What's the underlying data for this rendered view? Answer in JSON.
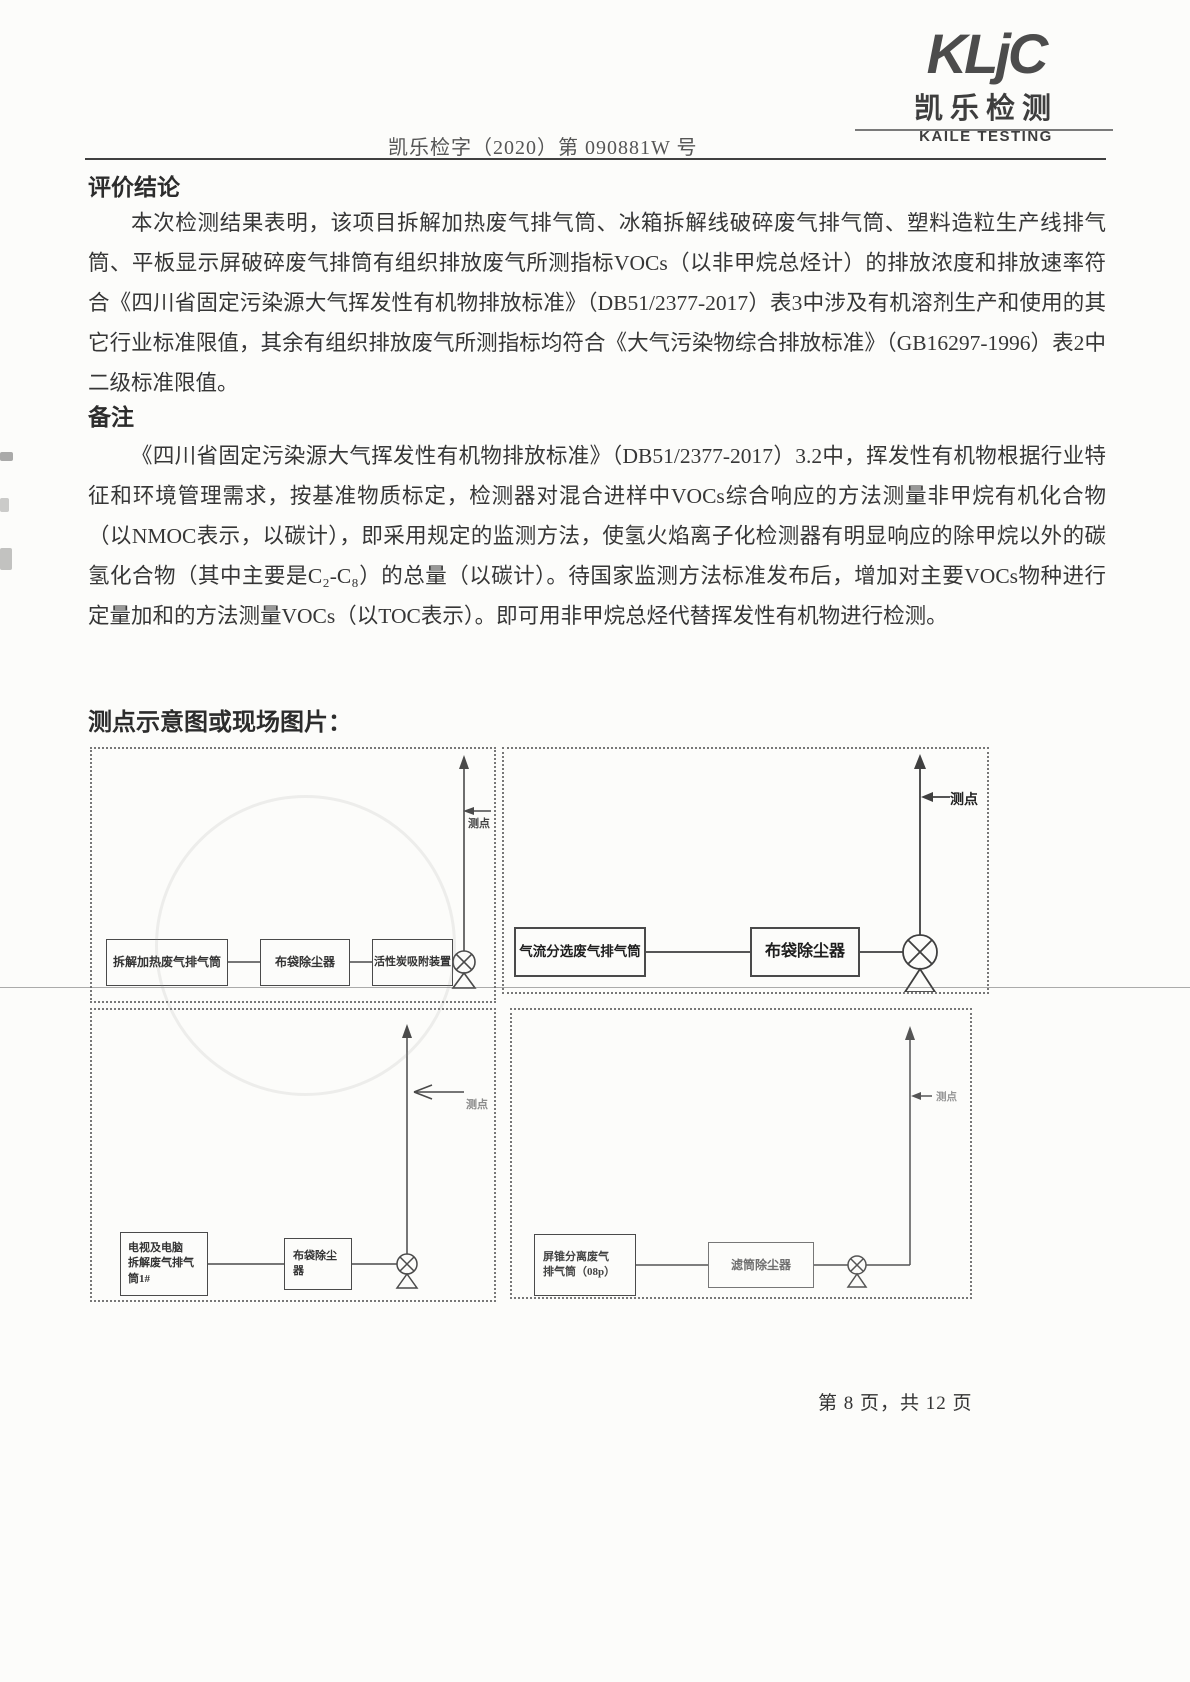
{
  "logo": {
    "brand": "KLjC",
    "name_cn": "凯乐检测",
    "name_en": "KAILE TESTING"
  },
  "header": {
    "doc_number": "凯乐检字（2020）第 090881W 号"
  },
  "sections": {
    "conclusion": {
      "heading": "评价结论",
      "body": "本次检测结果表明，该项目拆解加热废气排气筒、冰箱拆解线破碎废气排气筒、塑料造粒生产线排气筒、平板显示屏破碎废气排筒有组织排放废气所测指标VOCs（以非甲烷总烃计）的排放浓度和排放速率符合《四川省固定污染源大气挥发性有机物排放标准》（DB51/2377-2017）表3中涉及有机溶剂生产和使用的其它行业标准限值，其余有组织排放废气所测指标均符合《大气污染物综合排放标准》（GB16297-1996）表2中二级标准限值。"
    },
    "remark": {
      "heading": "备注",
      "body": "《四川省固定污染源大气挥发性有机物排放标准》（DB51/2377-2017）3.2中，挥发性有机物根据行业特征和环境管理需求，按基准物质标定，检测器对混合进样中VOCs综合响应的方法测量非甲烷有机化合物（以NMOC表示，以碳计），即采用规定的监测方法，使氢火焰离子化检测器有明显响应的除甲烷以外的碳氢化合物（其中主要是C₂-C₈）的总量（以碳计）。待国家监测方法标准发布后，增加对主要VOCs物种进行定量加和的方法测量VOCs（以TOC表示）。即可用非甲烷总烃代替挥发性有机物进行检测。"
    },
    "diagrams": {
      "heading": "测点示意图或现场图片：",
      "panels": [
        {
          "boxes": [
            "拆解加热废气排气筒",
            "布袋除尘器",
            "活性炭吸附装置"
          ],
          "point_label": "测点"
        },
        {
          "boxes": [
            "气流分选废气排气筒",
            "布袋除尘器"
          ],
          "point_label": "测点"
        },
        {
          "boxes": [
            "电视及电脑\n拆解废气排气\n筒1#",
            "布袋除尘\n器"
          ],
          "point_label": "测点"
        },
        {
          "boxes": [
            "屏锥分离废气\n排气筒（08p）",
            "滤筒除尘器"
          ],
          "point_label": "测点"
        }
      ]
    }
  },
  "footer": {
    "page_info": "第 8 页，共 12 页"
  },
  "colors": {
    "line": "#4a4a4a",
    "rule": "#404040",
    "faded_text": "#777"
  }
}
